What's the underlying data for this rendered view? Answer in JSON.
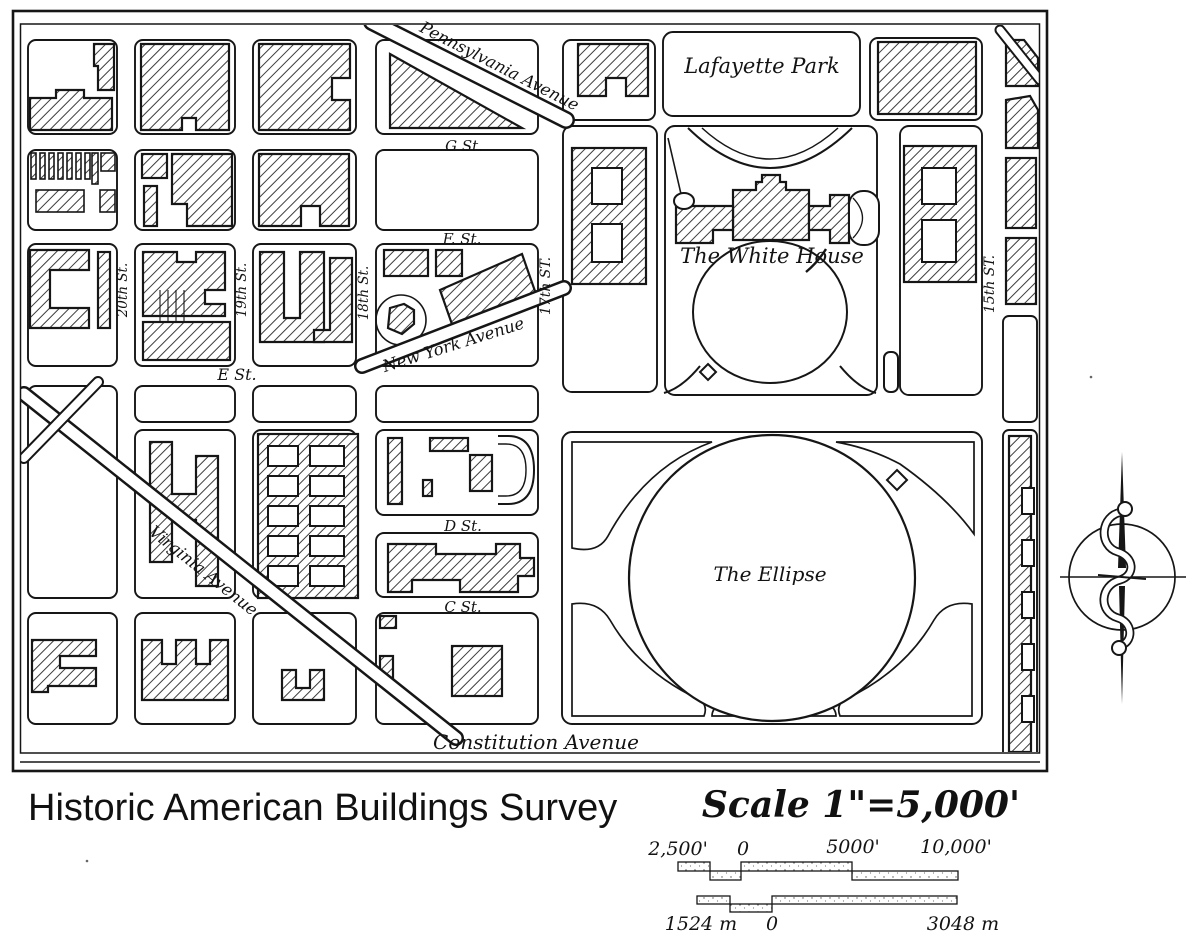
{
  "colors": {
    "ink": "#161616",
    "paper": "#ffffff"
  },
  "map": {
    "street_labels": {
      "pennsylvania": "Pennsylvania Avenue",
      "g": "G St.",
      "f": "F. St.",
      "e": "E St.",
      "d": "D St.",
      "c": "C St.",
      "new_york": "New York Avenue",
      "virginia": "Virginia Avenue",
      "constitution": "Constitution Avenue",
      "st20": "20th St.",
      "st19": "19th St.",
      "st18": "18th St.",
      "st17": "17th ST.",
      "st15": "15th ST."
    },
    "place_labels": {
      "lafayette": "Lafayette Park",
      "white_house": "The White House",
      "ellipse": "The Ellipse"
    }
  },
  "footer": {
    "survey_title": "Historic American Buildings Survey",
    "scale_heading": "Scale 1\"=5,000'"
  },
  "scale_bars": {
    "feet": {
      "labels": [
        "2,500'",
        "0",
        "5000'",
        "10,000'"
      ]
    },
    "meters": {
      "labels": [
        "1524 m",
        "0",
        "3048 m"
      ]
    }
  },
  "icons": {
    "compass": "compass-rose-icon"
  }
}
